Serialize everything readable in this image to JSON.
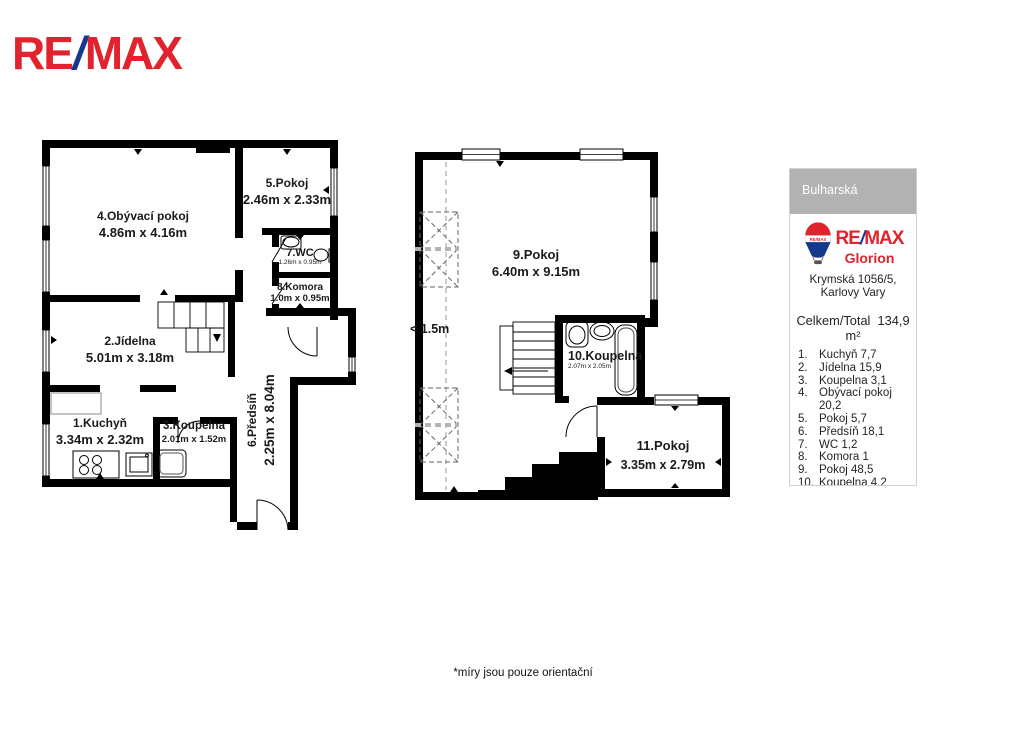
{
  "brand_logo": {
    "re": "RE",
    "slash": "/",
    "max": "MAX"
  },
  "plans": {
    "left": {
      "rooms": [
        {
          "name": "4.Obývací pokoj",
          "dims": "4.86m x 4.16m"
        },
        {
          "name": "5.Pokoj",
          "dims": "2.46m x 2.33m"
        },
        {
          "name": "7.WC",
          "dims": "1.26m x 0.95m"
        },
        {
          "name": "8.Komora",
          "dims": "1.0m x 0.95m"
        },
        {
          "name": "2.Jídelna",
          "dims": "5.01m x 3.18m"
        },
        {
          "name": "1.Kuchyň",
          "dims": "3.34m x 2.32m"
        },
        {
          "name": "3.Koupelna",
          "dims": "2.01m x 1.52m"
        },
        {
          "name": "6.Předsíň",
          "dims": "2.25m x 8.04m"
        }
      ]
    },
    "right": {
      "rooms": [
        {
          "name": "9.Pokoj",
          "dims": "6.40m x 9.15m"
        },
        {
          "name": "10.Koupelna",
          "dims": "2.07m x 2.05m"
        },
        {
          "name": "11.Pokoj",
          "dims": "3.35m x 2.79m"
        }
      ],
      "annotation": "< 1.5m"
    }
  },
  "info_panel": {
    "location": "Bulharská",
    "balloon_text": "RE/MAX",
    "brand": {
      "re": "RE",
      "slash": "/",
      "max": "MAX"
    },
    "office": "Glorion",
    "address": "Krymská 1056/5, Karlovy Vary",
    "total_label": "Celkem/Total",
    "total_value": "134,9 m²",
    "room_list": [
      {
        "num": "1.",
        "text": "Kuchyň 7,7"
      },
      {
        "num": "2.",
        "text": "Jídelna 15,9"
      },
      {
        "num": "3.",
        "text": "Koupelna 3,1"
      },
      {
        "num": "4.",
        "text": "Obývací pokoj 20,2"
      },
      {
        "num": "5.",
        "text": "Pokoj 5,7"
      },
      {
        "num": "6.",
        "text": "Předsíň 18,1"
      },
      {
        "num": "7.",
        "text": "WC 1,2"
      },
      {
        "num": "8.",
        "text": "Komora 1"
      },
      {
        "num": "9.",
        "text": "Pokoj 48,5"
      },
      {
        "num": "10.",
        "text": "Koupelna 4,2"
      },
      {
        "num": "11.",
        "text": "Pokoj 9,3"
      }
    ]
  },
  "footer": {
    "note": "*míry jsou pouze orientační"
  },
  "colors": {
    "brand_red": "#e0232d",
    "brand_blue": "#15388f",
    "header_gray": "#b2b2b2",
    "wall_black": "#000000"
  }
}
